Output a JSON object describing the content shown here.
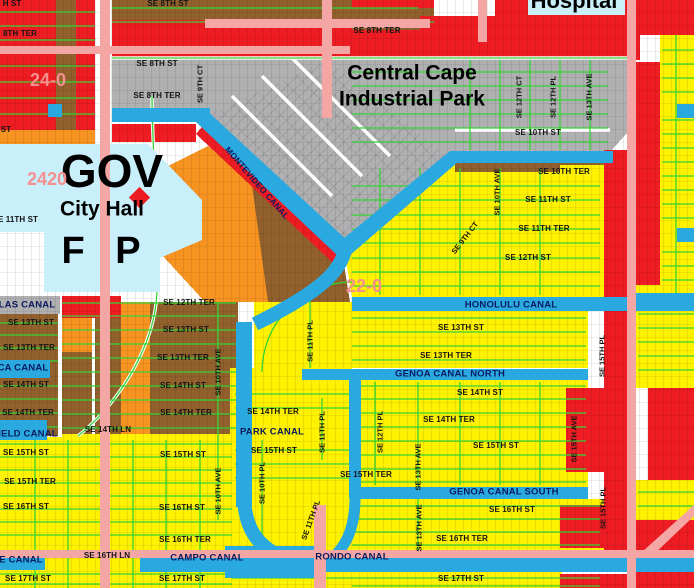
{
  "map_type": "municipal zoning / parcel map",
  "palette": {
    "red_zone": "#ee1c23",
    "yellow_zone": "#fef200",
    "orange_zone": "#f79421",
    "brown_zone": "#91602c",
    "gray_zone": "#b0b0b2",
    "civic_cyan": "#c9effa",
    "canal_blue": "#2aa9e1",
    "major_road_pink": "#f4a6a5",
    "street_green": "#35d435",
    "canal_label_navy": "#0a1b5e",
    "section_label_pink": "#f5908f"
  },
  "labels": [
    {
      "kind": "street",
      "text": "H ST",
      "x": 12,
      "y": 4
    },
    {
      "kind": "street",
      "text": "SE 8TH ST",
      "x": 168,
      "y": 4
    },
    {
      "kind": "street",
      "text": "8TH TER",
      "x": 20,
      "y": 34
    },
    {
      "kind": "street",
      "text": "SE 8TH TER",
      "x": 377,
      "y": 31
    },
    {
      "kind": "street",
      "text": "SE 8TH ST",
      "x": 157,
      "y": 64
    },
    {
      "kind": "street",
      "text": "SE 8TH TER",
      "x": 157,
      "y": 96
    },
    {
      "kind": "street",
      "text": "SE 10TH ST",
      "x": 538,
      "y": 133
    },
    {
      "kind": "street",
      "text": "SE 10TH TER",
      "x": 564,
      "y": 172
    },
    {
      "kind": "street",
      "text": "SE 11TH ST",
      "x": 548,
      "y": 200
    },
    {
      "kind": "street",
      "text": "SE 11TH TER",
      "x": 544,
      "y": 229
    },
    {
      "kind": "street",
      "text": "SE 12TH ST",
      "x": 528,
      "y": 258
    },
    {
      "kind": "street",
      "text": "ST",
      "x": 6,
      "y": 130
    },
    {
      "kind": "street",
      "text": "E 11TH ST",
      "x": 18,
      "y": 220
    },
    {
      "kind": "street",
      "text": "SE 12TH TER",
      "x": 189,
      "y": 303
    },
    {
      "kind": "street",
      "text": "SE 13TH ST",
      "x": 31,
      "y": 323
    },
    {
      "kind": "street",
      "text": "SE 13TH ST",
      "x": 186,
      "y": 330
    },
    {
      "kind": "street",
      "text": "SE 13TH ST",
      "x": 461,
      "y": 328
    },
    {
      "kind": "street",
      "text": "SE 13TH TER",
      "x": 29,
      "y": 348
    },
    {
      "kind": "street",
      "text": "SE 13TH TER",
      "x": 183,
      "y": 358
    },
    {
      "kind": "street",
      "text": "SE 13TH TER",
      "x": 446,
      "y": 356
    },
    {
      "kind": "street",
      "text": "SE 14TH ST",
      "x": 26,
      "y": 385
    },
    {
      "kind": "street",
      "text": "SE 14TH ST",
      "x": 183,
      "y": 386
    },
    {
      "kind": "street",
      "text": "SE 14TH ST",
      "x": 480,
      "y": 393
    },
    {
      "kind": "street",
      "text": "SE 14TH TER",
      "x": 28,
      "y": 413
    },
    {
      "kind": "street",
      "text": "SE 14TH TER",
      "x": 186,
      "y": 413
    },
    {
      "kind": "street",
      "text": "SE 14TH TER",
      "x": 273,
      "y": 412
    },
    {
      "kind": "street",
      "text": "SE 14TH TER",
      "x": 449,
      "y": 420
    },
    {
      "kind": "street",
      "text": "SE 14TH LN",
      "x": 108,
      "y": 430
    },
    {
      "kind": "street",
      "text": "SE 15TH ST",
      "x": 26,
      "y": 453
    },
    {
      "kind": "street",
      "text": "SE 15TH ST",
      "x": 183,
      "y": 455
    },
    {
      "kind": "street",
      "text": "SE 15TH ST",
      "x": 274,
      "y": 451
    },
    {
      "kind": "street",
      "text": "SE 15TH ST",
      "x": 496,
      "y": 446
    },
    {
      "kind": "street",
      "text": "SE 15TH TER",
      "x": 30,
      "y": 482
    },
    {
      "kind": "street",
      "text": "SE 15TH TER",
      "x": 366,
      "y": 475
    },
    {
      "kind": "street",
      "text": "SE 16TH ST",
      "x": 26,
      "y": 507
    },
    {
      "kind": "street",
      "text": "SE 16TH ST",
      "x": 182,
      "y": 508
    },
    {
      "kind": "street",
      "text": "SE 16TH ST",
      "x": 512,
      "y": 510
    },
    {
      "kind": "street",
      "text": "SE 16TH TER",
      "x": 185,
      "y": 540
    },
    {
      "kind": "street",
      "text": "SE 16TH TER",
      "x": 462,
      "y": 539
    },
    {
      "kind": "street",
      "text": "SE 16TH LN",
      "x": 107,
      "y": 556
    },
    {
      "kind": "street",
      "text": "SE 17TH ST",
      "x": 28,
      "y": 579
    },
    {
      "kind": "street",
      "text": "SE 17TH ST",
      "x": 182,
      "y": 579
    },
    {
      "kind": "street",
      "text": "SE 17TH ST",
      "x": 461,
      "y": 579
    },
    {
      "kind": "vstreet",
      "text": "SE 9TH CT",
      "x": 200,
      "y": 84,
      "rot": -90
    },
    {
      "kind": "vstreet",
      "text": "SE 9TH CT",
      "x": 465,
      "y": 238,
      "rot": -52
    },
    {
      "kind": "vstreet",
      "text": "SE 12TH CT",
      "x": 519,
      "y": 97,
      "rot": -90
    },
    {
      "kind": "vstreet",
      "text": "SE 12TH PL",
      "x": 553,
      "y": 97,
      "rot": -90
    },
    {
      "kind": "vstreet",
      "text": "SE 13TH AVE",
      "x": 589,
      "y": 97,
      "rot": -90
    },
    {
      "kind": "vstreet",
      "text": "SE 10TH AVE",
      "x": 497,
      "y": 192,
      "rot": -90
    },
    {
      "kind": "vstreet",
      "text": "SE 10TH AVE",
      "x": 218,
      "y": 372,
      "rot": -90
    },
    {
      "kind": "vstreet",
      "text": "SE 10TH AVE",
      "x": 218,
      "y": 491,
      "rot": -90
    },
    {
      "kind": "vstreet",
      "text": "SE 10TH PL",
      "x": 262,
      "y": 483,
      "rot": -90
    },
    {
      "kind": "vstreet",
      "text": "SE 11TH PL",
      "x": 310,
      "y": 341,
      "rot": -90
    },
    {
      "kind": "vstreet",
      "text": "SE 11TH PL",
      "x": 322,
      "y": 432,
      "rot": -90
    },
    {
      "kind": "vstreet",
      "text": "SE 11TH PL",
      "x": 311,
      "y": 520,
      "rot": -70
    },
    {
      "kind": "vstreet",
      "text": "SE 12TH PL",
      "x": 380,
      "y": 432,
      "rot": -90
    },
    {
      "kind": "vstreet",
      "text": "SE 13TH AVE",
      "x": 418,
      "y": 467,
      "rot": -90
    },
    {
      "kind": "vstreet",
      "text": "SE 13TH AVE",
      "x": 419,
      "y": 528,
      "rot": -90
    },
    {
      "kind": "vstreet",
      "text": "SE 15TH AVE",
      "x": 574,
      "y": 439,
      "rot": -90
    },
    {
      "kind": "vstreet",
      "text": "SE 15TH PL",
      "x": 602,
      "y": 356,
      "rot": -90
    },
    {
      "kind": "vstreet",
      "text": "SE 15TH PL",
      "x": 603,
      "y": 508,
      "rot": -90
    },
    {
      "kind": "canal",
      "text": "MONTEVIDEO CANAL",
      "x": 257,
      "y": 183,
      "rot": 49,
      "size": 8.5
    },
    {
      "kind": "canal",
      "text": "LAS CANAL",
      "x": 27,
      "y": 305
    },
    {
      "kind": "canal",
      "text": "CA CANAL",
      "x": 23,
      "y": 368
    },
    {
      "kind": "canal",
      "text": "IELD CANAL",
      "x": 28,
      "y": 434
    },
    {
      "kind": "canal",
      "text": "E CANAL",
      "x": 21,
      "y": 560
    },
    {
      "kind": "canal",
      "text": "HONOLULU CANAL",
      "x": 511,
      "y": 305
    },
    {
      "kind": "canal",
      "text": "GENOA CANAL NORTH",
      "x": 450,
      "y": 374
    },
    {
      "kind": "canal",
      "text": "GENOA CANAL SOUTH",
      "x": 504,
      "y": 492
    },
    {
      "kind": "canal",
      "text": "PARK CANAL",
      "x": 272,
      "y": 432
    },
    {
      "kind": "canal",
      "text": "CAMPO CANAL",
      "x": 207,
      "y": 558
    },
    {
      "kind": "canal",
      "text": "RONDO CANAL",
      "x": 352,
      "y": 557
    },
    {
      "kind": "area",
      "text": "Central Cape",
      "x": 412,
      "y": 73,
      "size": 21
    },
    {
      "kind": "area",
      "text": "Industrial Park",
      "x": 412,
      "y": 99,
      "size": 21
    },
    {
      "kind": "area",
      "text": "Hospital",
      "x": 574,
      "y": 1,
      "size": 22
    },
    {
      "kind": "area",
      "text": "GOV",
      "x": 112,
      "y": 171,
      "size": 46
    },
    {
      "kind": "area",
      "text": "City Hall",
      "x": 102,
      "y": 209,
      "size": 21
    },
    {
      "kind": "area",
      "text": "F P",
      "x": 101,
      "y": 251,
      "size": 38,
      "ws": 20
    },
    {
      "kind": "section",
      "text": "24-0",
      "x": 48,
      "y": 80
    },
    {
      "kind": "section",
      "text": "2420",
      "x": 47,
      "y": 179
    },
    {
      "kind": "section",
      "text": "22-0",
      "x": 364,
      "y": 286
    }
  ]
}
